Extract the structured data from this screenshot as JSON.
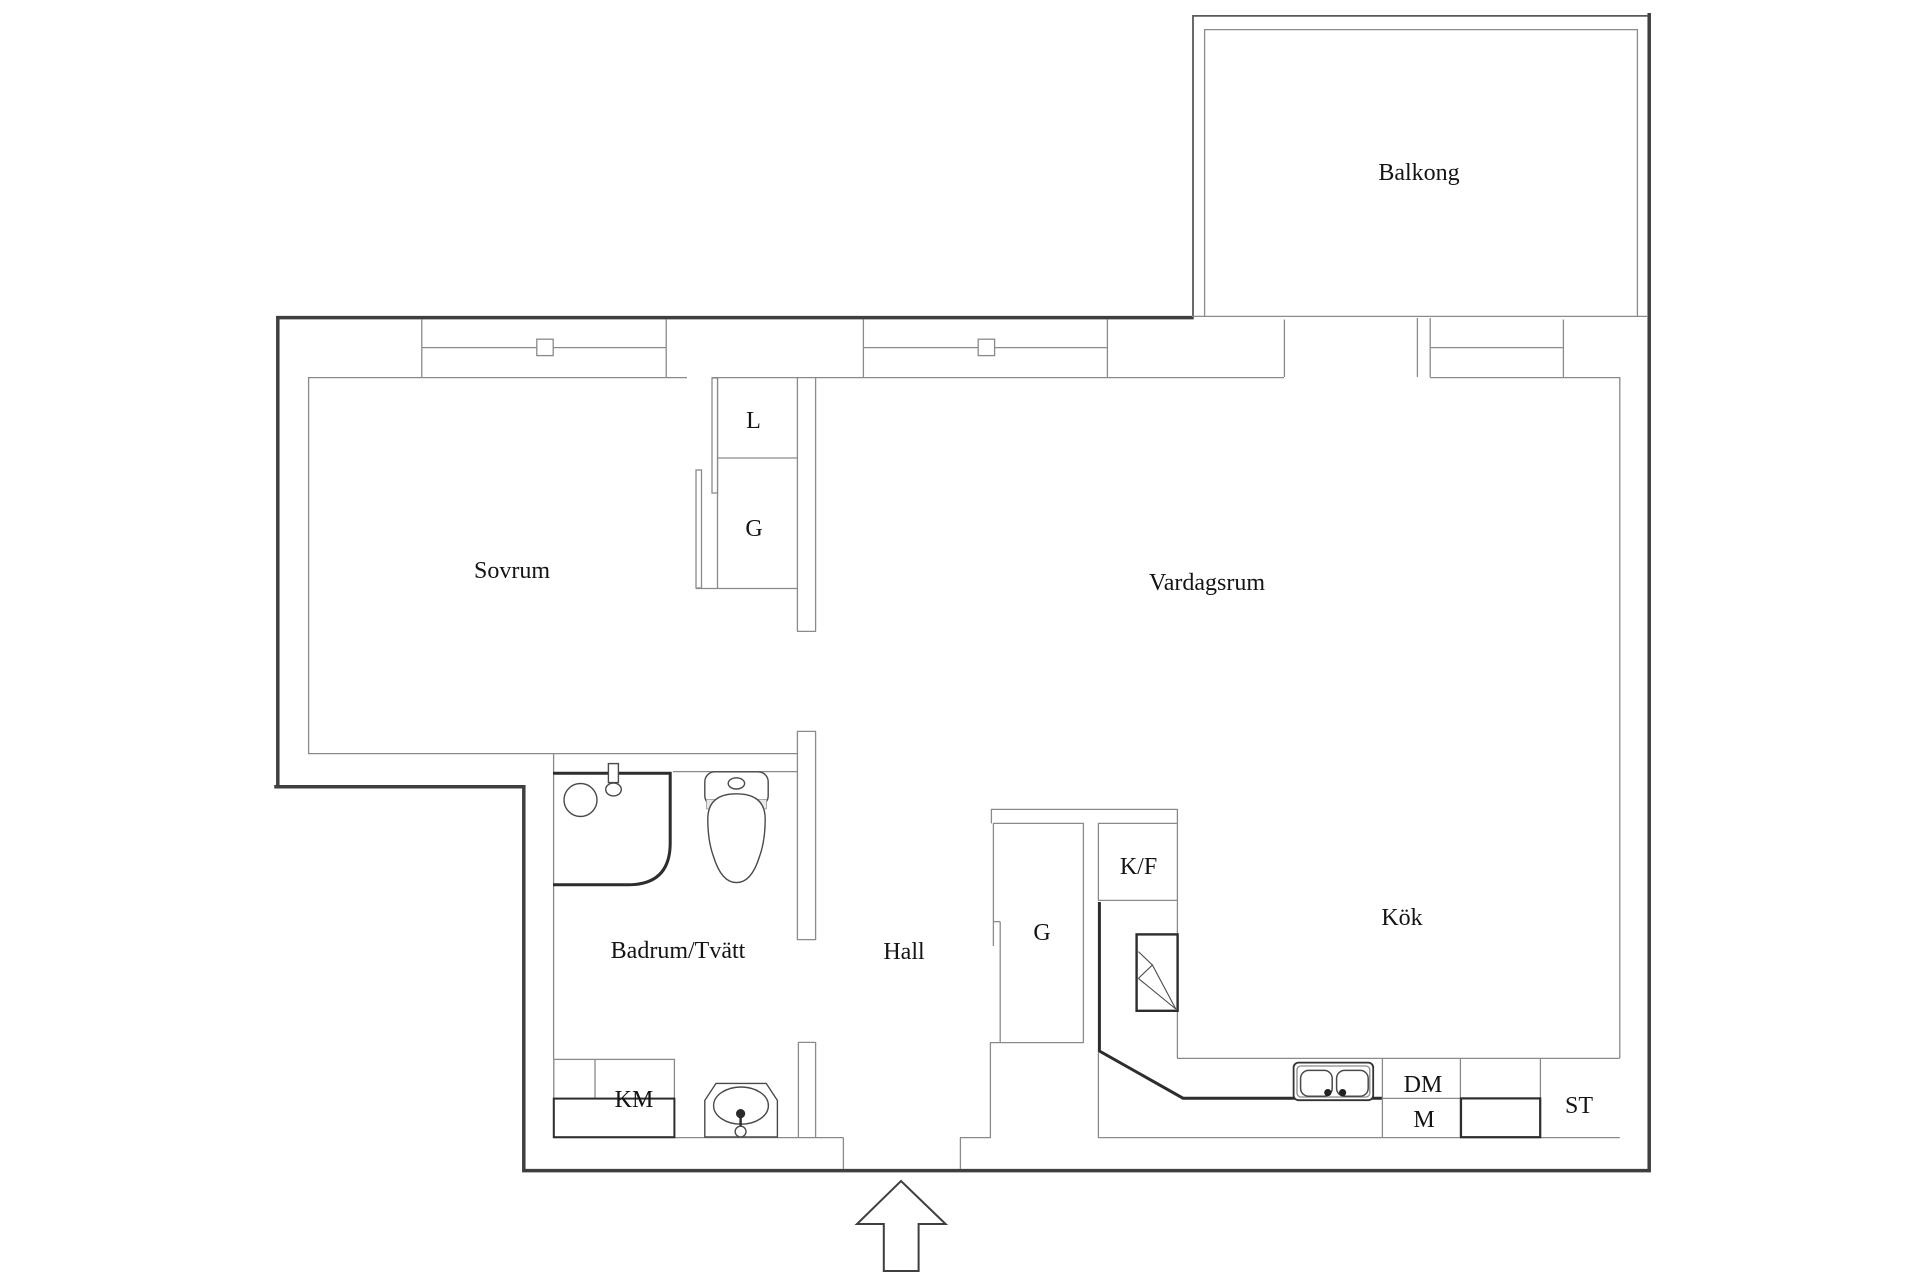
{
  "plan": {
    "type": "apartment-floor-plan",
    "language": "Swedish",
    "rooms": {
      "balkong": "Balkong",
      "sovrum": "Sovrum",
      "vardagsrum": "Vardagsrum",
      "kok": "Kök",
      "hall": "Hall",
      "badrum": "Badrum/Tvätt"
    },
    "closets": {
      "linen_closet": "L",
      "wardrobe_sovrum": "G",
      "wardrobe_hall": "G"
    },
    "appliances": {
      "fridge_freezer": "K/F",
      "washing_machine": "KM",
      "dishwasher": "DM",
      "microwave": "M",
      "cleaning_closet": "ST"
    }
  },
  "colors": {
    "background": "#ffffff",
    "exterior_wall": "#3f3f3f",
    "interior_line": "#8a8a8a",
    "fixture_line": "#4a4a4a",
    "label_text": "#141414"
  }
}
